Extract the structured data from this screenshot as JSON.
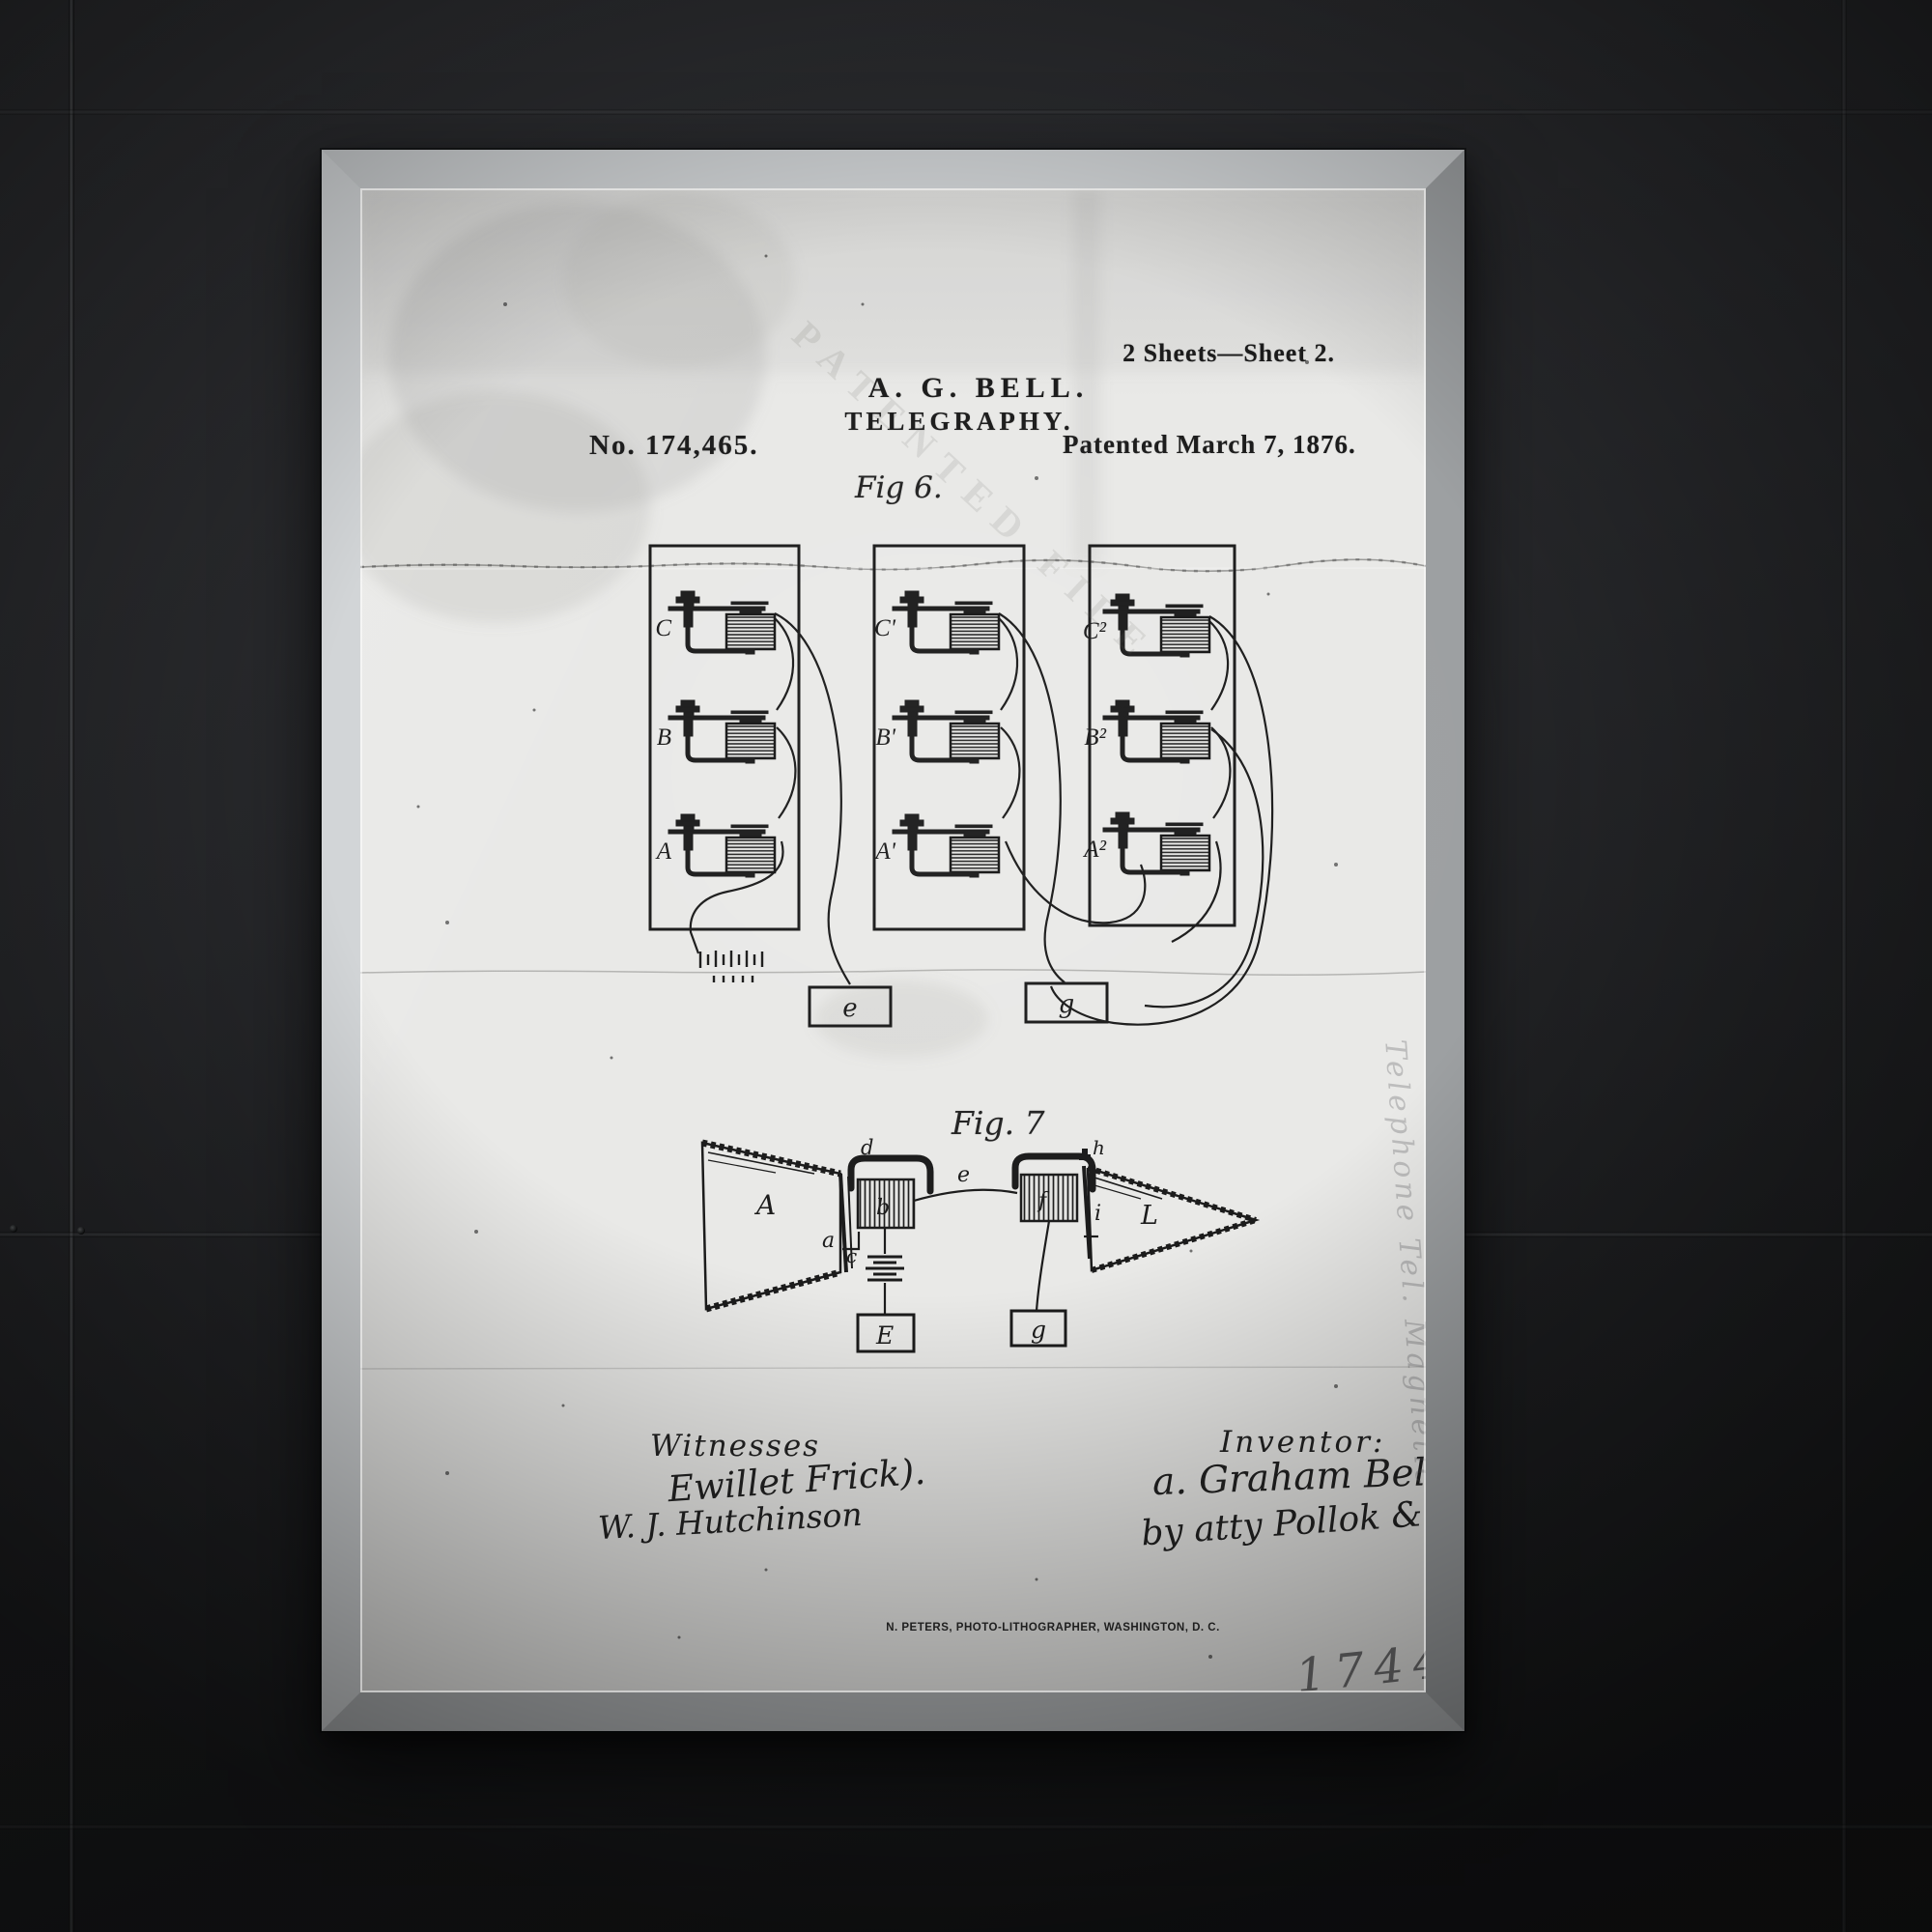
{
  "poster": {
    "header": {
      "sheet_info": "2 Sheets—Sheet 2.",
      "inventor_abbrev": "A. G. BELL.",
      "title": "TELEGRAPHY.",
      "patent_number": "No. 174,465.",
      "patent_date": "Patented March 7, 1876.",
      "stamp_text": "PATENTED FILE"
    },
    "fig6": {
      "label": "Fig 6.",
      "unit_labels": [
        "C",
        "B",
        "A",
        "C'",
        "B'",
        "A'",
        "C²",
        "B²",
        "A²"
      ],
      "box_e": "e",
      "box_g": "g"
    },
    "fig7": {
      "label": "Fig. 7",
      "cone_left": "A",
      "label_d": "d",
      "label_a": "a",
      "label_c": "c",
      "coil_left": "b",
      "wire_label": "e",
      "coil_right": "f",
      "label_h": "h",
      "label_i": "i",
      "cone_right": "L",
      "battery_box": "E",
      "ground_box": "g"
    },
    "signatures": {
      "witnesses_heading": "Witnesses",
      "witness1": "Ewillet Frick).",
      "witness2": "W. J. Hutchinson",
      "inventor_heading": "Inventor:",
      "inventor_signature": "a. Graham Bell",
      "attorney_line": "by atty Pollok & Bailey"
    },
    "footer": {
      "lithographer": "N. PETERS, PHOTO-LITHOGRAPHER, WASHINGTON, D. C."
    },
    "annotations": {
      "margin_note": "Telephone Tel. Magnetic",
      "corner_number": "174465"
    },
    "colors": {
      "wall": "#232427",
      "frame_silver": "#b9bcbe",
      "paper": "#e9e9e7",
      "ink": "#1b1b1b"
    }
  }
}
